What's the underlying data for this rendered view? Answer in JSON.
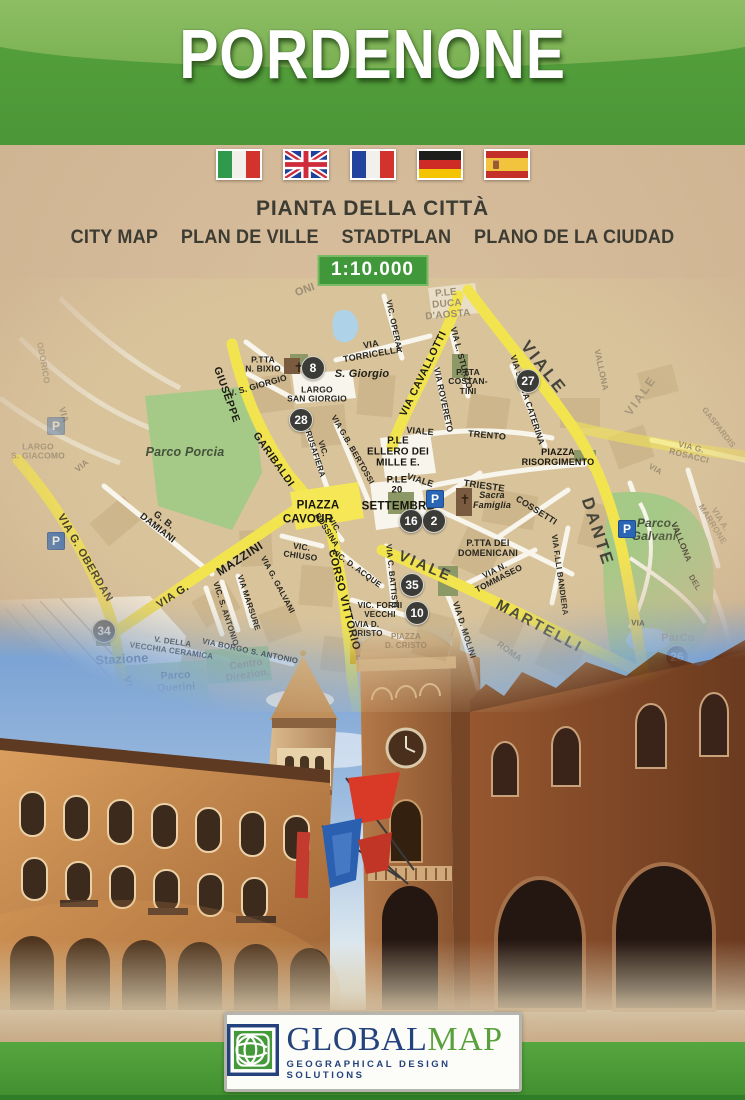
{
  "cover": {
    "title": "PORDENONE",
    "subtitle_primary": "PIANTA DELLA CITTÀ",
    "languages": [
      "CITY MAP",
      "PLAN DE VILLE",
      "STADTPLAN",
      "PLANO DE LA CIUDAD"
    ],
    "scale": "1:10.000",
    "flags": [
      "italy",
      "united-kingdom",
      "france",
      "germany",
      "spain"
    ]
  },
  "map": {
    "parking_glyph": "P",
    "labels": [
      {
        "t": "ONI",
        "x": 305,
        "y": 12,
        "r": -20,
        "s": 11,
        "c": "faded"
      },
      {
        "t": "P.LE\nDUCA\nD'AOSTA",
        "x": 447,
        "y": 26,
        "r": -5,
        "s": 10,
        "c": "faded"
      },
      {
        "t": "VIA\nTORRICELLA",
        "x": 372,
        "y": 72,
        "r": -10,
        "s": 9,
        "c": "street"
      },
      {
        "t": "VIC. OPERAI",
        "x": 393,
        "y": 47,
        "r": 78,
        "s": 8,
        "c": "street"
      },
      {
        "t": "VIA CAVALLOTTI",
        "x": 424,
        "y": 96,
        "r": -64,
        "s": 10.5,
        "c": "road"
      },
      {
        "t": "VIA L. STURZO",
        "x": 461,
        "y": 80,
        "r": 75,
        "s": 8.5,
        "c": "street"
      },
      {
        "t": "VIA SANTA CATERINA",
        "x": 527,
        "y": 122,
        "r": 72,
        "s": 8.5,
        "c": "street"
      },
      {
        "t": "P.TTA\nCOSTAN-\nTINI",
        "x": 468,
        "y": 104,
        "r": 0,
        "s": 8.5,
        "c": "street"
      },
      {
        "t": "VIALE",
        "x": 543,
        "y": 90,
        "r": 52,
        "s": 17,
        "c": "bigroad"
      },
      {
        "t": "VIALE",
        "x": 641,
        "y": 118,
        "r": -55,
        "s": 12,
        "c": "fadedbig"
      },
      {
        "t": "VALLONA",
        "x": 601,
        "y": 92,
        "r": 78,
        "s": 8.5,
        "c": "faded"
      },
      {
        "t": "GASPARDIS",
        "x": 718,
        "y": 150,
        "r": 52,
        "s": 8,
        "c": "faded"
      },
      {
        "t": "VIA G. ROSACCI",
        "x": 690,
        "y": 174,
        "r": 14,
        "s": 8.5,
        "c": "faded"
      },
      {
        "t": "VIA A. MARRONE",
        "x": 716,
        "y": 244,
        "r": 58,
        "s": 8.5,
        "c": "faded"
      },
      {
        "t": "✝",
        "x": 299,
        "y": 90,
        "r": 0,
        "s": 13,
        "c": "cross"
      },
      {
        "t": "S. Giorgio",
        "x": 362,
        "y": 96,
        "r": 0,
        "s": 11,
        "c": "poi"
      },
      {
        "t": "P.TTA\nN. BIXIO",
        "x": 263,
        "y": 87,
        "r": 0,
        "s": 8.5,
        "c": "street"
      },
      {
        "t": "V. S. GIORGIO",
        "x": 258,
        "y": 108,
        "r": -16,
        "s": 8.5,
        "c": "street"
      },
      {
        "t": "LARGO\nSAN GIORGIO",
        "x": 317,
        "y": 117,
        "r": 0,
        "s": 8.5,
        "c": "street"
      },
      {
        "t": "GIUSEPPE",
        "x": 226,
        "y": 117,
        "r": 70,
        "s": 10.5,
        "c": "road"
      },
      {
        "t": "GARIBALDI",
        "x": 273,
        "y": 182,
        "r": 55,
        "s": 10.5,
        "c": "road"
      },
      {
        "t": "VIC.\nBRUSAFIERA",
        "x": 318,
        "y": 172,
        "r": 72,
        "s": 8,
        "c": "street"
      },
      {
        "t": "VIA G.B. BERTOSSI",
        "x": 352,
        "y": 172,
        "r": 60,
        "s": 8,
        "c": "street"
      },
      {
        "t": "VIA ROVERETO",
        "x": 443,
        "y": 122,
        "r": 78,
        "s": 8.5,
        "c": "street"
      },
      {
        "t": "VIALE",
        "x": 420,
        "y": 154,
        "r": 5,
        "s": 9,
        "c": "street"
      },
      {
        "t": "TRENTO",
        "x": 487,
        "y": 158,
        "r": 5,
        "s": 9,
        "c": "street"
      },
      {
        "t": "P.LE\nELLERO DEI\nMILLE E.",
        "x": 398,
        "y": 174,
        "r": 0,
        "s": 10,
        "c": "place"
      },
      {
        "t": "PIAZZA\nRISORGIMENTO",
        "x": 558,
        "y": 180,
        "r": 0,
        "s": 9,
        "c": "place"
      },
      {
        "t": "P.LE\n20",
        "x": 397,
        "y": 208,
        "r": 0,
        "s": 9.5,
        "c": "place"
      },
      {
        "t": "SETTEMBRE",
        "x": 398,
        "y": 229,
        "r": 0,
        "s": 11.5,
        "c": "place"
      },
      {
        "t": "PIAZZA",
        "x": 318,
        "y": 228,
        "r": 0,
        "s": 11.5,
        "c": "place"
      },
      {
        "t": "CAVOUR",
        "x": 308,
        "y": 242,
        "r": 0,
        "s": 11.5,
        "c": "place"
      },
      {
        "t": "VIALE",
        "x": 420,
        "y": 203,
        "r": 18,
        "s": 9,
        "c": "street"
      },
      {
        "t": "TRIESTE",
        "x": 484,
        "y": 209,
        "r": 8,
        "s": 9.5,
        "c": "street"
      },
      {
        "t": "Sacra\nFamiglia",
        "x": 492,
        "y": 223,
        "r": 0,
        "s": 9,
        "c": "poi"
      },
      {
        "t": "✝",
        "x": 465,
        "y": 222,
        "r": 0,
        "s": 13,
        "c": "cross"
      },
      {
        "t": "COSSETTI",
        "x": 536,
        "y": 233,
        "r": 32,
        "s": 9,
        "c": "street"
      },
      {
        "t": "P.TTA DEI\nDOMENICANI",
        "x": 488,
        "y": 271,
        "r": 0,
        "s": 9,
        "c": "street"
      },
      {
        "t": "VIALE",
        "x": 425,
        "y": 289,
        "r": 23,
        "s": 15,
        "c": "bigroad"
      },
      {
        "t": "MARTELLI",
        "x": 539,
        "y": 349,
        "r": 28,
        "s": 15,
        "c": "bigroad"
      },
      {
        "t": "DANTE",
        "x": 597,
        "y": 254,
        "r": 72,
        "s": 17,
        "c": "bigroad"
      },
      {
        "t": "VIA N.\nTOMMASEO",
        "x": 497,
        "y": 297,
        "r": -27,
        "s": 8.5,
        "c": "street"
      },
      {
        "t": "VIA F.LLI BANDIERA",
        "x": 559,
        "y": 297,
        "r": 82,
        "s": 8,
        "c": "street"
      },
      {
        "t": "VIA D. MOLINI",
        "x": 464,
        "y": 352,
        "r": 72,
        "s": 8.5,
        "c": "street"
      },
      {
        "t": "ROMA",
        "x": 509,
        "y": 374,
        "r": 36,
        "s": 9,
        "c": "faded"
      },
      {
        "t": "VIA C. BATTISTI",
        "x": 391,
        "y": 298,
        "r": 84,
        "s": 8,
        "c": "street"
      },
      {
        "t": "VIC. D. ACQUE",
        "x": 356,
        "y": 291,
        "r": 36,
        "s": 8,
        "c": "street"
      },
      {
        "t": "VIC.\nCHIUSO",
        "x": 301,
        "y": 274,
        "r": 8,
        "s": 8.5,
        "c": "street"
      },
      {
        "t": "VIC.\nBOSSINA",
        "x": 330,
        "y": 250,
        "r": 58,
        "s": 8,
        "c": "street"
      },
      {
        "t": "CORSO VITTORIO",
        "x": 344,
        "y": 322,
        "r": 76,
        "s": 11,
        "c": "road"
      },
      {
        "t": "VIC. FORNI\nVECCHI",
        "x": 380,
        "y": 333,
        "r": 0,
        "s": 8,
        "c": "street"
      },
      {
        "t": "VIA D.\nCRISTO",
        "x": 367,
        "y": 352,
        "r": 0,
        "s": 8,
        "c": "street"
      },
      {
        "t": "PIAZZA\nD. CRISTO",
        "x": 406,
        "y": 364,
        "r": 0,
        "s": 8,
        "c": "faded"
      },
      {
        "t": "VIA G. GALVANI",
        "x": 277,
        "y": 307,
        "r": 62,
        "s": 8,
        "c": "street"
      },
      {
        "t": "VIA MARSURE",
        "x": 248,
        "y": 325,
        "r": 72,
        "s": 8,
        "c": "street"
      },
      {
        "t": "VIC. S. ANTONIO",
        "x": 225,
        "y": 336,
        "r": 72,
        "s": 8,
        "c": "street"
      },
      {
        "t": "VIA BORGO S. ANTONIO",
        "x": 250,
        "y": 374,
        "r": 12,
        "s": 8,
        "c": "street"
      },
      {
        "t": "V. DELLA\nVECCHIA CERAMICA",
        "x": 172,
        "y": 369,
        "r": 8,
        "s": 8,
        "c": "street"
      },
      {
        "t": "G. B.\nDAMIANI",
        "x": 160,
        "y": 247,
        "r": 38,
        "s": 9.5,
        "c": "street"
      },
      {
        "t": "VIA G.",
        "x": 173,
        "y": 318,
        "r": -33,
        "s": 11,
        "c": "road"
      },
      {
        "t": "MAZZINI",
        "x": 240,
        "y": 281,
        "r": -33,
        "s": 12,
        "c": "road"
      },
      {
        "t": "VIA G. OBERDAN",
        "x": 85,
        "y": 280,
        "r": 60,
        "s": 11,
        "c": "road"
      },
      {
        "t": "Stazione",
        "x": 122,
        "y": 382,
        "r": -3,
        "s": 12.5,
        "c": "gray"
      },
      {
        "t": "Parco\nQuerini",
        "x": 176,
        "y": 404,
        "r": -3,
        "s": 10.5,
        "c": "gray"
      },
      {
        "t": "Centro\nDirezion.",
        "x": 247,
        "y": 392,
        "r": -8,
        "s": 10,
        "c": "faded"
      },
      {
        "t": "VIA",
        "x": 128,
        "y": 408,
        "r": 75,
        "s": 10.5,
        "c": "road"
      },
      {
        "t": "Parco Porcia",
        "x": 185,
        "y": 175,
        "r": 0,
        "s": 12.5,
        "c": "park"
      },
      {
        "t": "LARGO\nS. GIACOMO",
        "x": 38,
        "y": 174,
        "r": 0,
        "s": 8.5,
        "c": "faded"
      },
      {
        "t": "VIA",
        "x": 63,
        "y": 137,
        "r": 75,
        "s": 9,
        "c": "faded"
      },
      {
        "t": "ODORICO",
        "x": 43,
        "y": 85,
        "r": 80,
        "s": 8.5,
        "c": "faded"
      },
      {
        "t": "VIA",
        "x": 82,
        "y": 188,
        "r": -40,
        "s": 8.5,
        "c": "faded"
      },
      {
        "t": "Parco\nGalvani",
        "x": 654,
        "y": 252,
        "r": 0,
        "s": 12,
        "c": "park"
      },
      {
        "t": "VALLONA",
        "x": 681,
        "y": 264,
        "r": 68,
        "s": 8.5,
        "c": "street"
      },
      {
        "t": "ParCo",
        "x": 678,
        "y": 360,
        "r": 0,
        "s": 11,
        "c": "faded"
      },
      {
        "t": "VIA SANTI",
        "x": 710,
        "y": 399,
        "r": -12,
        "s": 8.5,
        "c": "street"
      },
      {
        "t": "VIA",
        "x": 638,
        "y": 346,
        "r": 4,
        "s": 8,
        "c": "street"
      },
      {
        "t": "DEL",
        "x": 694,
        "y": 305,
        "r": 60,
        "s": 8,
        "c": "street"
      },
      {
        "t": "VIA",
        "x": 655,
        "y": 192,
        "r": 30,
        "s": 8,
        "c": "faded"
      }
    ],
    "badges": [
      {
        "n": "8",
        "x": 313,
        "y": 90
      },
      {
        "n": "28",
        "x": 301,
        "y": 142
      },
      {
        "n": "27",
        "x": 528,
        "y": 103
      },
      {
        "n": "16",
        "x": 411,
        "y": 243
      },
      {
        "n": "2",
        "x": 434,
        "y": 243
      },
      {
        "n": "35",
        "x": 412,
        "y": 307
      },
      {
        "n": "10",
        "x": 417,
        "y": 335
      },
      {
        "n": "34",
        "x": 104,
        "y": 353
      },
      {
        "n": "26",
        "x": 677,
        "y": 379
      }
    ],
    "parking": [
      {
        "x": 435,
        "y": 221
      },
      {
        "x": 627,
        "y": 251
      },
      {
        "x": 56,
        "y": 263
      },
      {
        "x": 62,
        "y": 401
      },
      {
        "x": 56,
        "y": 148,
        "f": 1
      }
    ]
  },
  "logo": {
    "word_primary": "GLOBAL",
    "word_secondary": "MAP",
    "tagline": "GEOGRAPHICAL DESIGN SOLUTIONS"
  },
  "colors": {
    "header_green": "#4b9637",
    "scale_badge_green": "#41983a",
    "road_yellow": "#f2e44f",
    "park_green": "#a5c987",
    "parking_blue": "#2a66b4",
    "logo_blue": "#24427c",
    "logo_green": "#5aa03c",
    "background_tan": "#cfb492"
  }
}
